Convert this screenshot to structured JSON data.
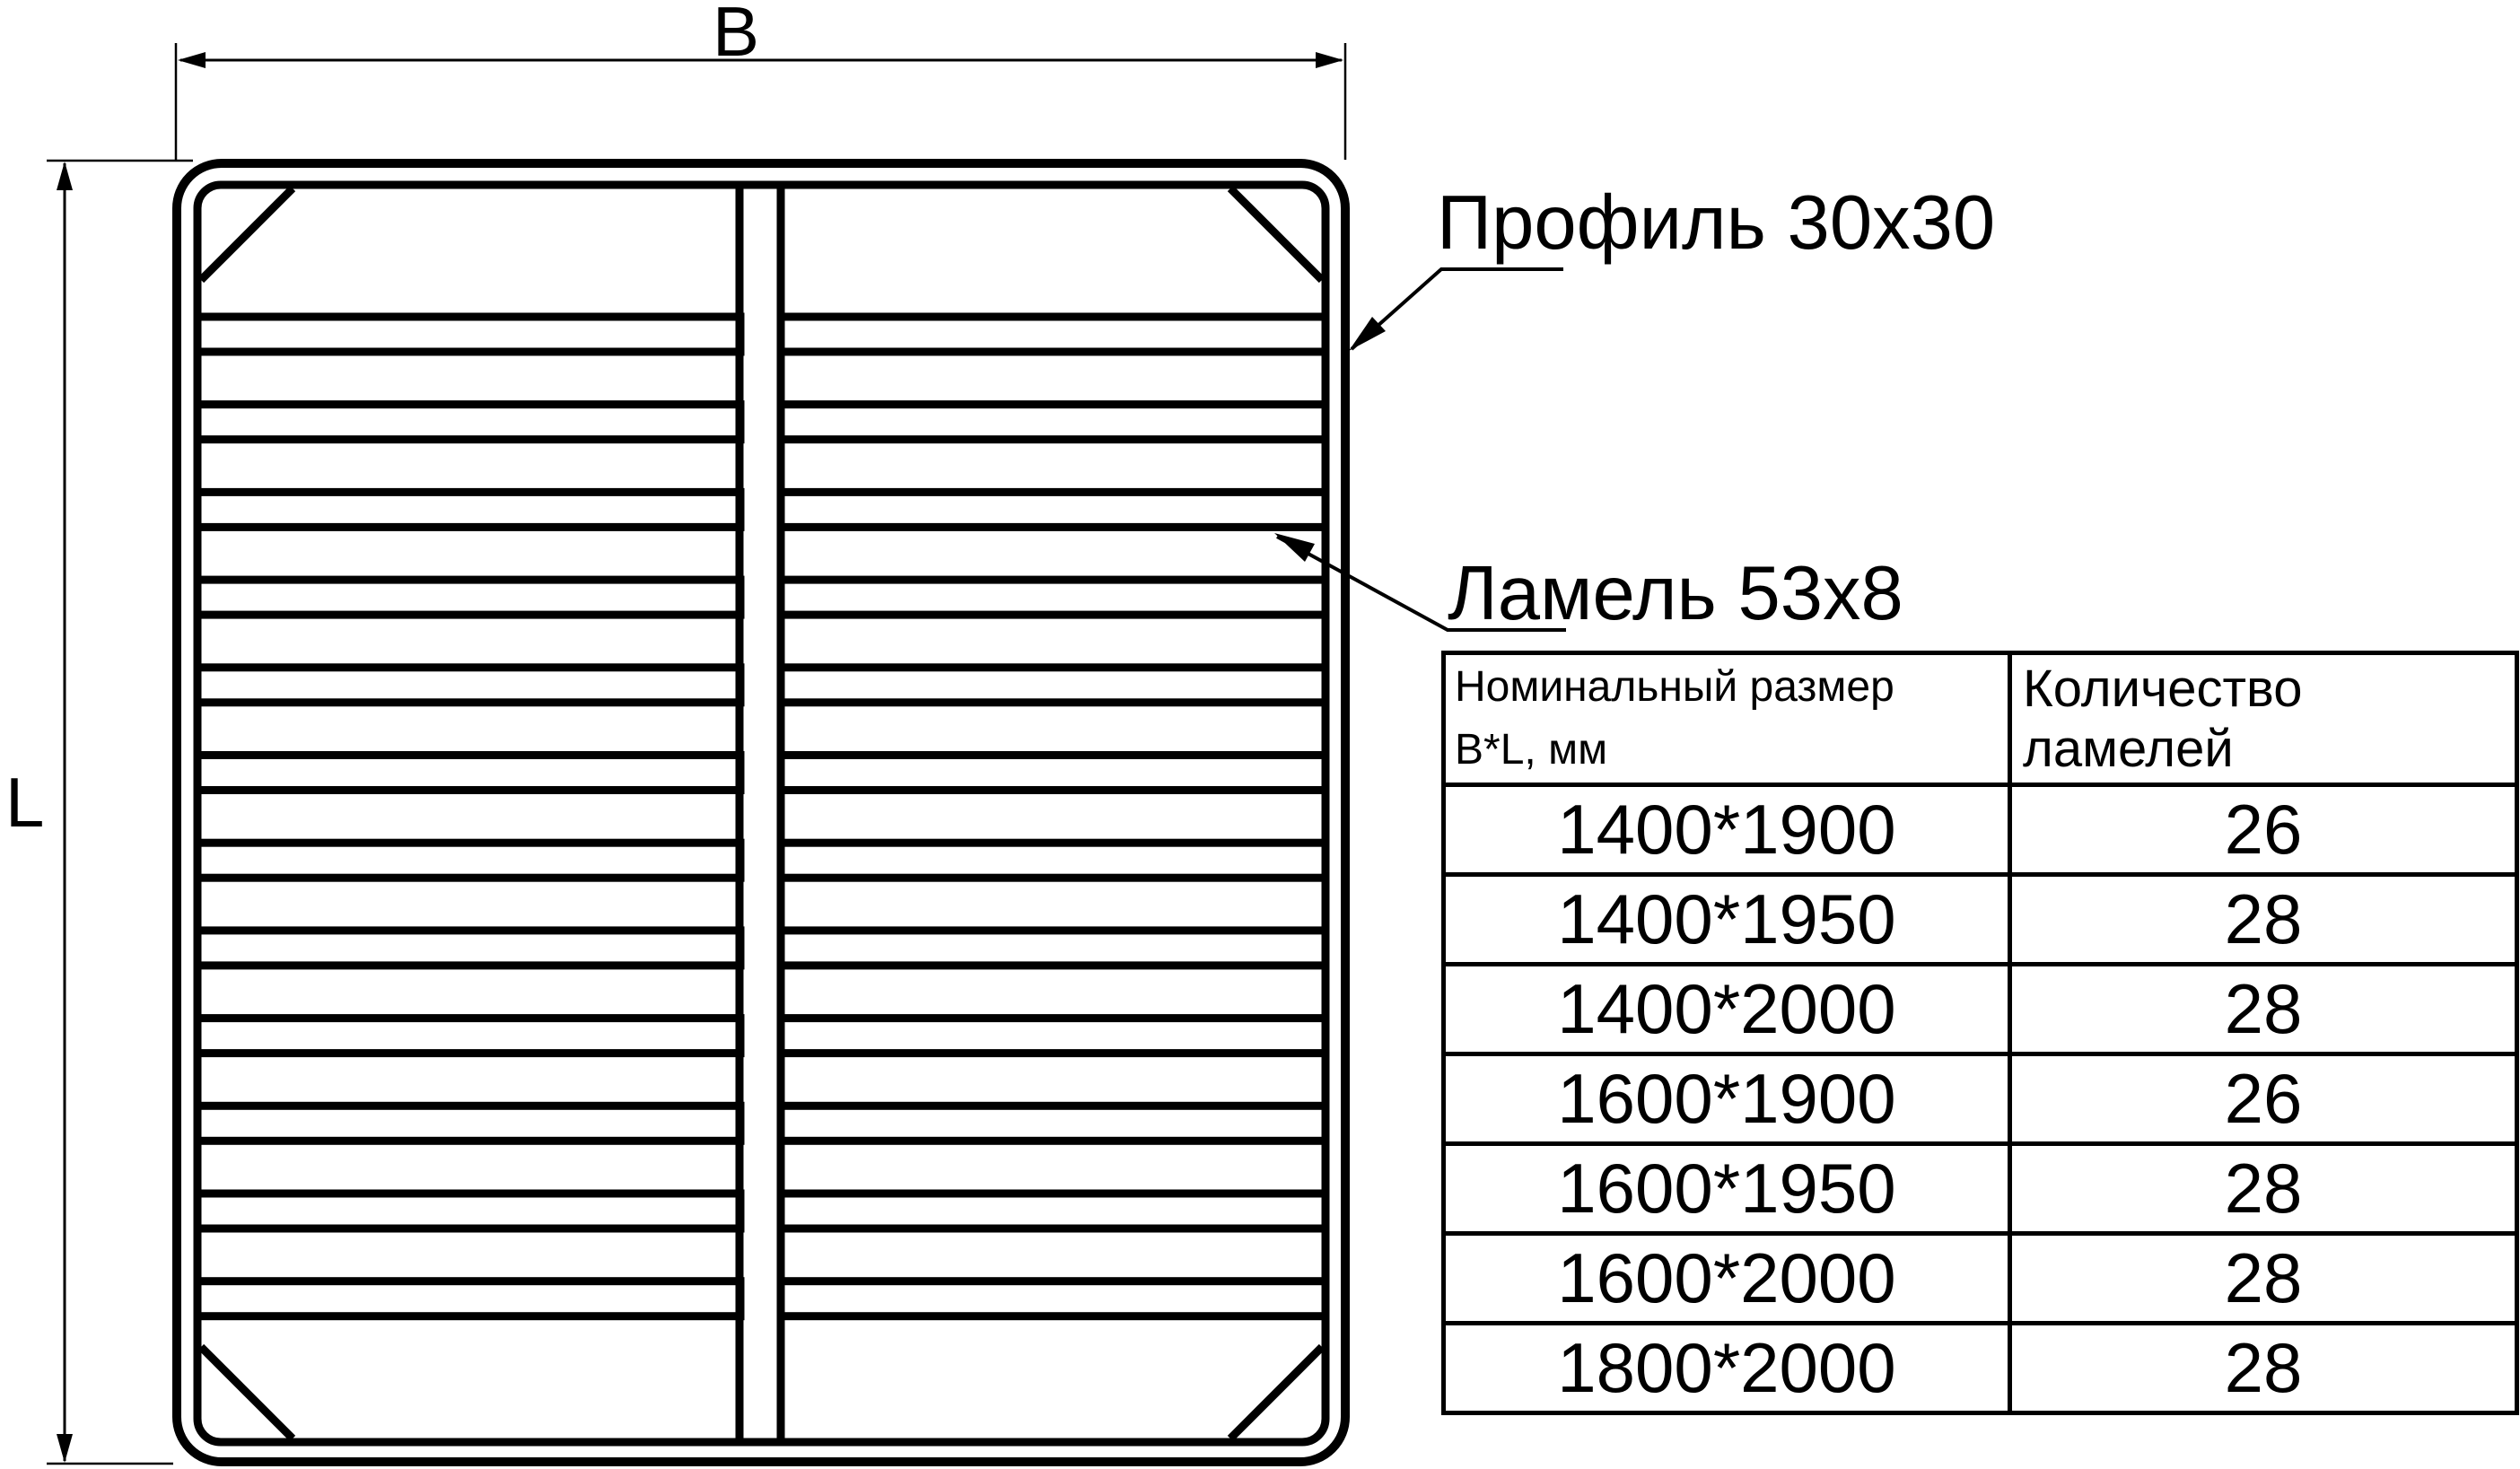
{
  "page": {
    "background": "#ffffff",
    "ink": "#000000"
  },
  "drawing": {
    "width_dim_label": "B",
    "length_dim_label": "L",
    "profile_callout": "Профиль 30x30",
    "lamel_callout": "Ламель 53x8"
  },
  "table": {
    "header": {
      "size_line1": "Номинальный размер",
      "size_line2": "B*L, мм",
      "quantity": "Количество ламелей"
    },
    "rows": [
      {
        "size": "1400*1900",
        "quantity": "26"
      },
      {
        "size": "1400*1950",
        "quantity": "28"
      },
      {
        "size": "1400*2000",
        "quantity": "28"
      },
      {
        "size": "1600*1900",
        "quantity": "26"
      },
      {
        "size": "1600*1950",
        "quantity": "28"
      },
      {
        "size": "1600*2000",
        "quantity": "28"
      },
      {
        "size": "1800*2000",
        "quantity": "28"
      }
    ]
  }
}
